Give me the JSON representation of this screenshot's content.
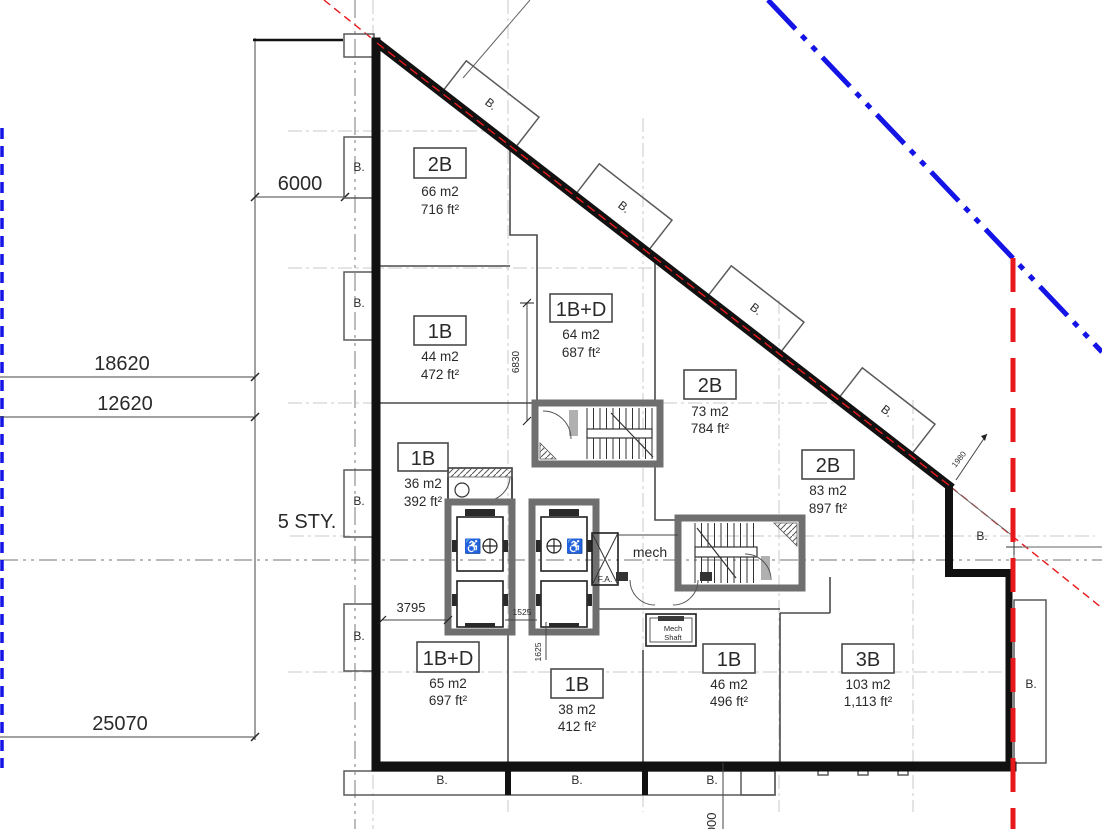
{
  "labels": {
    "balcony": "B.",
    "storeys": "5 STY.",
    "mech": "mech",
    "fire_alarm": "F.A.",
    "mech_shaft_1": "Mech",
    "mech_shaft_2": "Shaft"
  },
  "dimensions": {
    "d6000": "6000",
    "d18620": "18620",
    "d12620": "12620",
    "d25070": "25070",
    "d3795": "3795",
    "d1525": "1525",
    "d1625": "1625",
    "d6830": "6830",
    "d1980": "1980",
    "d6000_bottom": "6000"
  },
  "units": [
    {
      "type": "2B",
      "area_m2": "66 m2",
      "area_ft2": "716 ft²"
    },
    {
      "type": "1B",
      "area_m2": "44 m2",
      "area_ft2": "472 ft²"
    },
    {
      "type": "1B+D",
      "area_m2": "64 m2",
      "area_ft2": "687 ft²"
    },
    {
      "type": "2B",
      "area_m2": "73 m2",
      "area_ft2": "784 ft²"
    },
    {
      "type": "2B",
      "area_m2": "83 m2",
      "area_ft2": "897 ft²"
    },
    {
      "type": "1B",
      "area_m2": "36 m2",
      "area_ft2": "392 ft²"
    },
    {
      "type": "1B+D",
      "area_m2": "65 m2",
      "area_ft2": "697 ft²"
    },
    {
      "type": "1B",
      "area_m2": "38 m2",
      "area_ft2": "412 ft²"
    },
    {
      "type": "1B",
      "area_m2": "46 m2",
      "area_ft2": "496 ft²"
    },
    {
      "type": "3B",
      "area_m2": "103 m2",
      "area_ft2": "1,113 ft²"
    }
  ],
  "colors": {
    "wall": "#111111",
    "property_line_blue": "#1414e6",
    "setback_line_red": "#e8191c",
    "grid": "#c9c9c9"
  }
}
